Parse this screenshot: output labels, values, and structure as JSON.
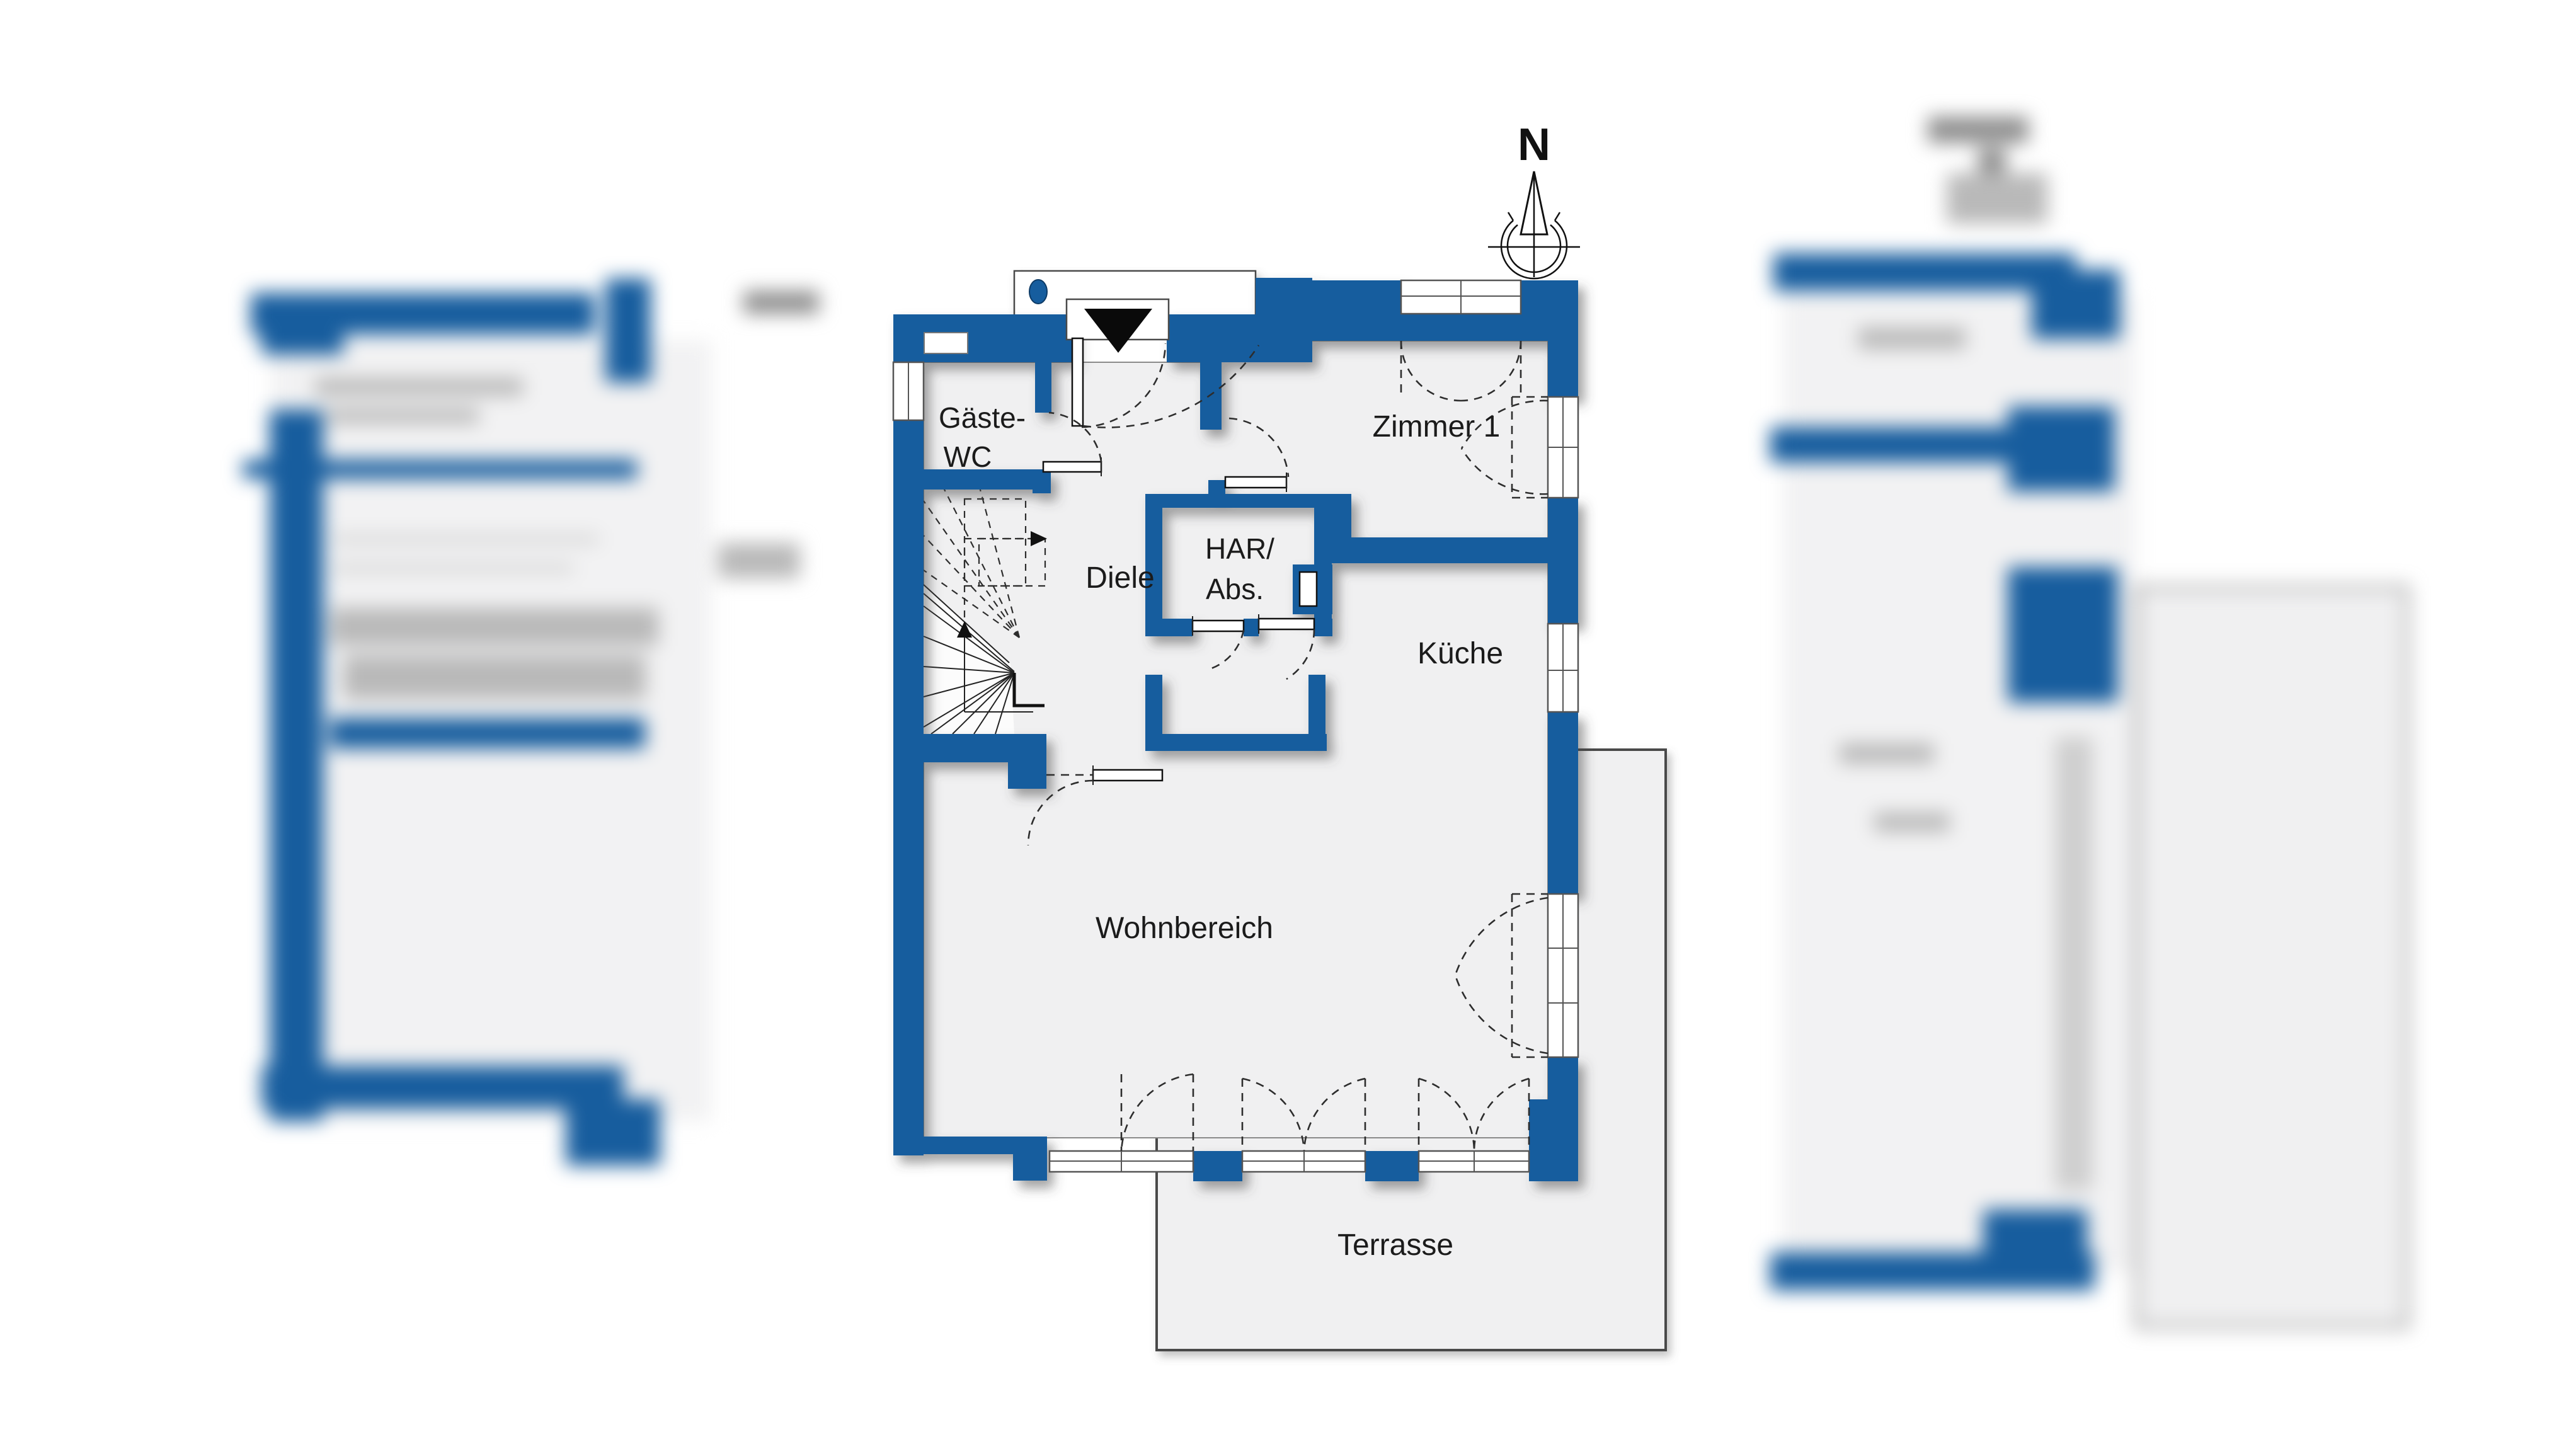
{
  "floorplan": {
    "labels": {
      "gaeste_wc_1": "Gäste-",
      "gaeste_wc_2": "WC",
      "diele": "Diele",
      "har_1": "HAR/",
      "har_2": "Abs.",
      "zimmer1": "Zimmer 1",
      "kueche": "Küche",
      "wohnbereich": "Wohnbereich",
      "terrasse": "Terrasse"
    },
    "compass": {
      "north_label": "N"
    },
    "colors": {
      "wall": "#175d9e",
      "floor": "#f0f0f1",
      "terrace-border": "#4a4a4a",
      "entry-dot": "#175d9e"
    }
  }
}
